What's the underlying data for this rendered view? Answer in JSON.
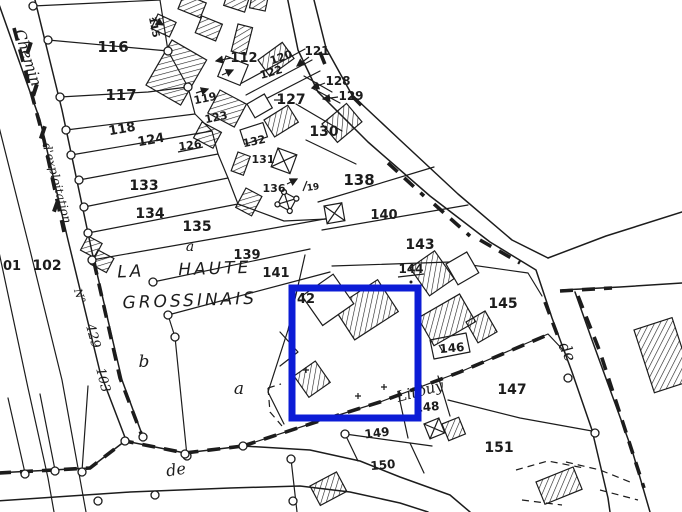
{
  "colors": {
    "ink": "#1c1c1c",
    "paper": "#ffffff",
    "highlight_blue": "#0c1cd6"
  },
  "highlight": {
    "description": "blue rectangle outlining parcel 142 area"
  },
  "place_name": {
    "word1": "LA",
    "word2": "HAUTE",
    "line2": "GROSSINAIS"
  },
  "road_labels": {
    "chemin": "Chemin",
    "exploitation": "d'exploitation",
    "numero_prefix": "N°",
    "numero_1": "429",
    "numero_2": "103",
    "de_south": "de",
    "de_east": "de",
    "litouy": "Litouy"
  },
  "zone_letters": {
    "a_135": "a",
    "a_main": "a",
    "b_main": "b"
  },
  "parcel_numbers": {
    "p101": "01",
    "p102": "102",
    "p112": "112",
    "p115": "115",
    "p116": "116",
    "p117": "117",
    "p118": "118",
    "p119": "119",
    "p120": "120",
    "p121": "121",
    "p122": "122",
    "p123": "123",
    "p124": "124",
    "p126": "126",
    "p127": "127",
    "p128": "128",
    "p129": "129",
    "p130": "130",
    "p131": "131",
    "p132": "132",
    "p133": "133",
    "p134": "134",
    "p135": "135",
    "p136": "136",
    "p138": "138",
    "p139": "139",
    "p140": "140",
    "p141": "141",
    "p142": "42",
    "p143": "143",
    "p144": "144",
    "p145": "145",
    "p146": "146",
    "p147": "147",
    "p148": "148",
    "p149": "149",
    "p150": "150",
    "p151": "151",
    "p19": "19"
  }
}
